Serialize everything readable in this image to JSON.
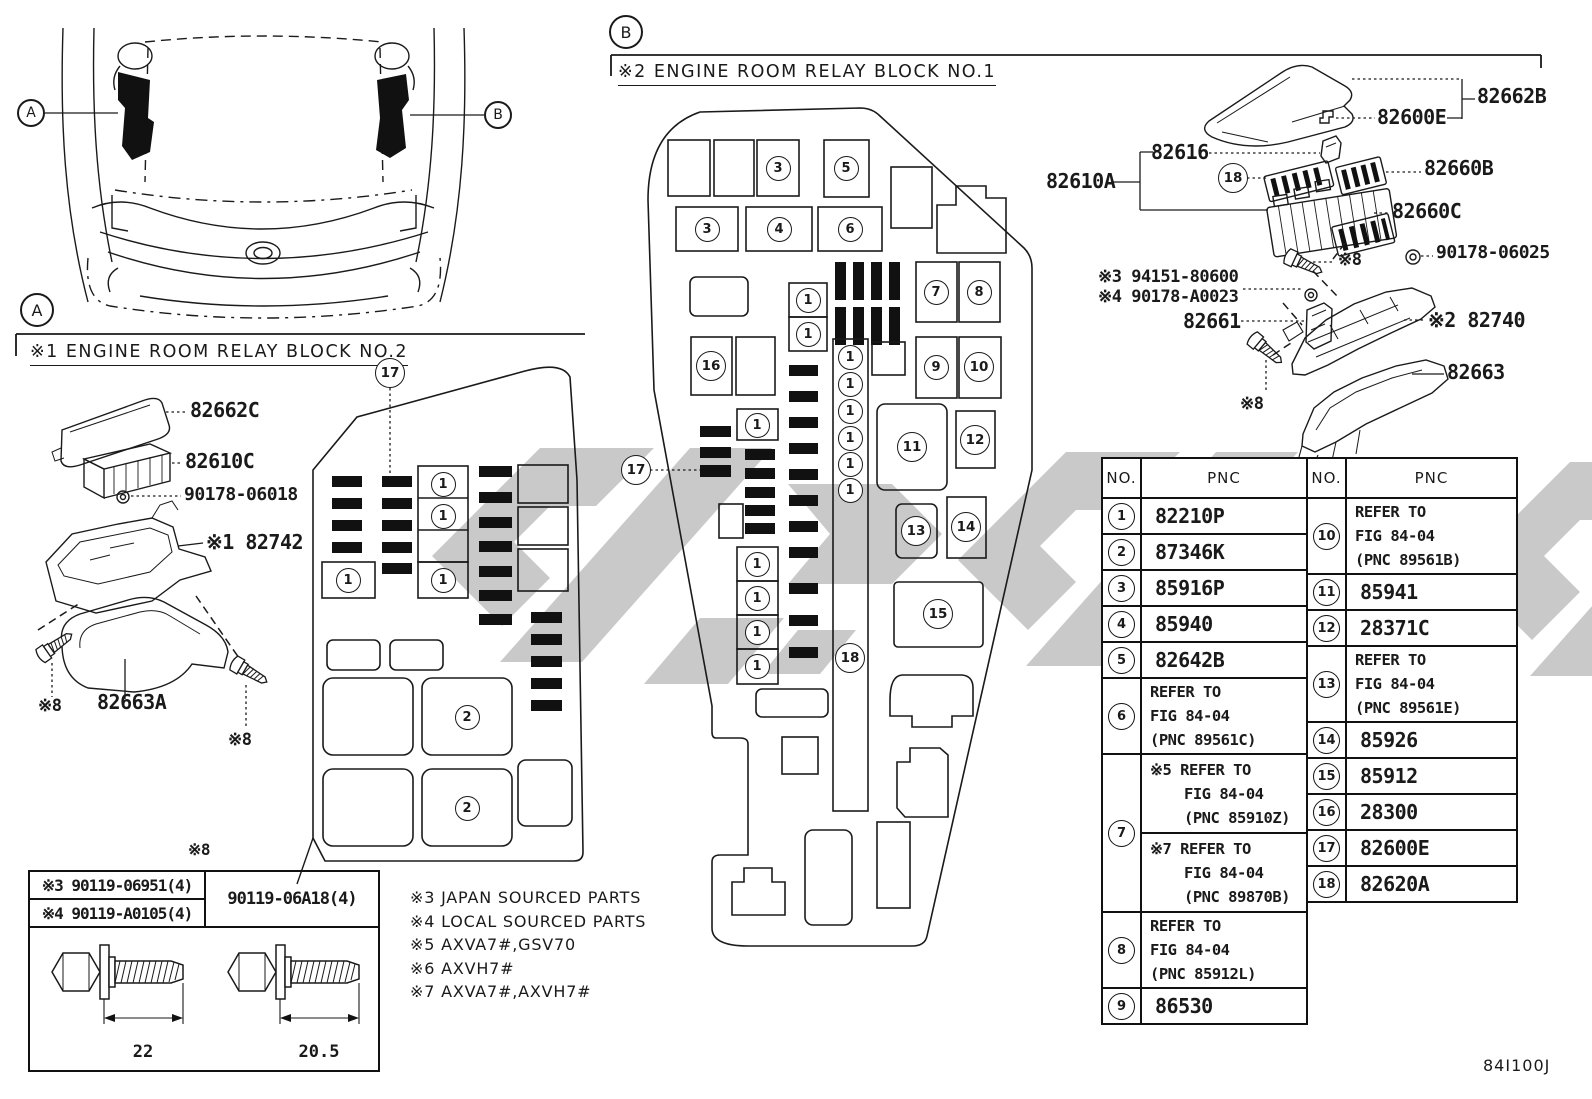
{
  "doc": {
    "code": "84I100J",
    "line_color": "#1a1a1a",
    "bar_color": "#111111",
    "watermark_color": "#c9c9c9"
  },
  "overview": {
    "callout_a": "A",
    "callout_b": "B"
  },
  "section_a": {
    "marker": "A",
    "title": "※1 ENGINE ROOM RELAY BLOCK NO.2",
    "fusebox_callouts": [
      {
        "n": "17",
        "x": 390,
        "y": 373,
        "big": true
      },
      {
        "n": "1",
        "x": 443,
        "y": 484
      },
      {
        "n": "1",
        "x": 443,
        "y": 516
      },
      {
        "n": "1",
        "x": 443,
        "y": 580
      },
      {
        "n": "1",
        "x": 348,
        "y": 580
      },
      {
        "n": "2",
        "x": 467,
        "y": 717
      },
      {
        "n": "2",
        "x": 467,
        "y": 808
      }
    ]
  },
  "section_b": {
    "marker": "B",
    "title": "※2 ENGINE ROOM RELAY BLOCK NO.1",
    "fusebox_callouts": [
      {
        "n": "3",
        "x": 778,
        "y": 168
      },
      {
        "n": "5",
        "x": 846,
        "y": 168
      },
      {
        "n": "3",
        "x": 707,
        "y": 229
      },
      {
        "n": "4",
        "x": 779,
        "y": 229
      },
      {
        "n": "6",
        "x": 850,
        "y": 229
      },
      {
        "n": "7",
        "x": 936,
        "y": 292
      },
      {
        "n": "8",
        "x": 979,
        "y": 292
      },
      {
        "n": "9",
        "x": 936,
        "y": 367
      },
      {
        "n": "10",
        "x": 979,
        "y": 367
      },
      {
        "n": "16",
        "x": 711,
        "y": 366
      },
      {
        "n": "1",
        "x": 808,
        "y": 300
      },
      {
        "n": "1",
        "x": 808,
        "y": 334
      },
      {
        "n": "1",
        "x": 850,
        "y": 357
      },
      {
        "n": "1",
        "x": 850,
        "y": 384
      },
      {
        "n": "1",
        "x": 850,
        "y": 411
      },
      {
        "n": "1",
        "x": 850,
        "y": 438
      },
      {
        "n": "1",
        "x": 850,
        "y": 464
      },
      {
        "n": "1",
        "x": 850,
        "y": 490
      },
      {
        "n": "1",
        "x": 757,
        "y": 425
      },
      {
        "n": "11",
        "x": 912,
        "y": 447
      },
      {
        "n": "12",
        "x": 975,
        "y": 440
      },
      {
        "n": "13",
        "x": 916,
        "y": 531
      },
      {
        "n": "14",
        "x": 966,
        "y": 527
      },
      {
        "n": "1",
        "x": 757,
        "y": 564
      },
      {
        "n": "1",
        "x": 757,
        "y": 598
      },
      {
        "n": "1",
        "x": 757,
        "y": 632
      },
      {
        "n": "1",
        "x": 757,
        "y": 666
      },
      {
        "n": "15",
        "x": 938,
        "y": 614
      },
      {
        "n": "18",
        "x": 850,
        "y": 658,
        "big": true
      },
      {
        "n": "17",
        "x": 636,
        "y": 470,
        "big": true
      }
    ]
  },
  "exploded_b_callouts": [
    {
      "n": "18",
      "x": 1233,
      "y": 178,
      "big": true
    }
  ],
  "part_labels": [
    {
      "id": "82662c",
      "text": "82662C",
      "x": 190,
      "y": 400,
      "size": 20
    },
    {
      "id": "82610c",
      "text": "82610C",
      "x": 185,
      "y": 451,
      "size": 20
    },
    {
      "id": "90178-06018",
      "text": "90178-06018",
      "x": 184,
      "y": 486,
      "size": 18
    },
    {
      "id": "82742",
      "text": "※1 82742",
      "x": 206,
      "y": 532,
      "size": 20
    },
    {
      "id": "note8-a1",
      "text": "※8",
      "x": 38,
      "y": 698,
      "size": 17
    },
    {
      "id": "82663a",
      "text": "82663A",
      "x": 97,
      "y": 692,
      "size": 20
    },
    {
      "id": "note8-a2",
      "text": "※8",
      "x": 228,
      "y": 732,
      "size": 17
    },
    {
      "id": "note8-table",
      "text": "※8",
      "x": 188,
      "y": 842,
      "size": 16
    },
    {
      "id": "82662b",
      "text": "82662B",
      "x": 1477,
      "y": 86,
      "size": 20
    },
    {
      "id": "82600e",
      "text": "82600E",
      "x": 1377,
      "y": 107,
      "size": 20
    },
    {
      "id": "82616",
      "text": "82616",
      "x": 1151,
      "y": 142,
      "size": 20
    },
    {
      "id": "82610a",
      "text": "82610A",
      "x": 1046,
      "y": 171,
      "size": 20
    },
    {
      "id": "82660b",
      "text": "82660B",
      "x": 1424,
      "y": 158,
      "size": 20
    },
    {
      "id": "82660c",
      "text": "82660C",
      "x": 1392,
      "y": 201,
      "size": 20
    },
    {
      "id": "90178-06025",
      "text": "90178-06025",
      "x": 1436,
      "y": 244,
      "size": 18
    },
    {
      "id": "note8-b1",
      "text": "※8",
      "x": 1338,
      "y": 252,
      "size": 17
    },
    {
      "id": "94151-80600",
      "text": "※3 94151-80600",
      "x": 1098,
      "y": 269,
      "size": 17
    },
    {
      "id": "90178-a0023",
      "text": "※4 90178-A0023",
      "x": 1098,
      "y": 289,
      "size": 17
    },
    {
      "id": "82661",
      "text": "82661",
      "x": 1183,
      "y": 311,
      "size": 20
    },
    {
      "id": "82740",
      "text": "※2 82740",
      "x": 1428,
      "y": 310,
      "size": 20
    },
    {
      "id": "82663",
      "text": "82663",
      "x": 1447,
      "y": 362,
      "size": 20
    },
    {
      "id": "note8-b2",
      "text": "※8",
      "x": 1240,
      "y": 396,
      "size": 17
    }
  ],
  "notes": [
    "※3 JAPAN SOURCED PARTS",
    "※4 LOCAL SOURCED PARTS",
    "※5 AXVA7#,GSV70",
    "※6 AXVH7#",
    "※7 AXVA7#,AXVH7#"
  ],
  "bolt_table": {
    "note": "※8",
    "left_header": [
      "※3 90119-06951(4)",
      "※4 90119-A0105(4)"
    ],
    "right_header": "90119-06A18(4)",
    "left_dim": "22",
    "right_dim": "20.5"
  },
  "parts_table": {
    "no_header": "NO.",
    "pnc_header": "PNC",
    "left": [
      {
        "no": "1",
        "lines": [
          "82210P"
        ]
      },
      {
        "no": "2",
        "lines": [
          "87346K"
        ]
      },
      {
        "no": "3",
        "lines": [
          "85916P"
        ]
      },
      {
        "no": "4",
        "lines": [
          "85940"
        ]
      },
      {
        "no": "5",
        "lines": [
          "82642B"
        ]
      },
      {
        "no": "6",
        "lines": [
          "REFER TO",
          "FIG 84-04",
          "(PNC 89561C)"
        ],
        "indent": false
      },
      {
        "no": "7",
        "sub": [
          {
            "lines": [
              "※5 REFER TO",
              "FIG 84-04",
              "(PNC 85910Z)"
            ],
            "indent": true
          },
          {
            "lines": [
              "※7 REFER TO",
              "FIG 84-04",
              "(PNC 89870B)"
            ],
            "indent": true
          }
        ]
      },
      {
        "no": "8",
        "lines": [
          "REFER TO",
          "FIG 84-04",
          "(PNC 85912L)"
        ],
        "indent": false
      },
      {
        "no": "9",
        "lines": [
          "86530"
        ]
      }
    ],
    "right": [
      {
        "no": "10",
        "lines": [
          "REFER TO",
          "FIG 84-04",
          "(PNC 89561B)"
        ],
        "indent": false
      },
      {
        "no": "11",
        "lines": [
          "85941"
        ]
      },
      {
        "no": "12",
        "lines": [
          "28371C"
        ]
      },
      {
        "no": "13",
        "lines": [
          "REFER TO",
          "FIG 84-04",
          "(PNC 89561E)"
        ],
        "indent": false
      },
      {
        "no": "14",
        "lines": [
          "85926"
        ]
      },
      {
        "no": "15",
        "lines": [
          "85912"
        ]
      },
      {
        "no": "16",
        "lines": [
          "28300"
        ]
      },
      {
        "no": "17",
        "lines": [
          "82600E"
        ]
      },
      {
        "no": "18",
        "lines": [
          "82620A"
        ]
      }
    ]
  },
  "footer_code": "84I100J"
}
